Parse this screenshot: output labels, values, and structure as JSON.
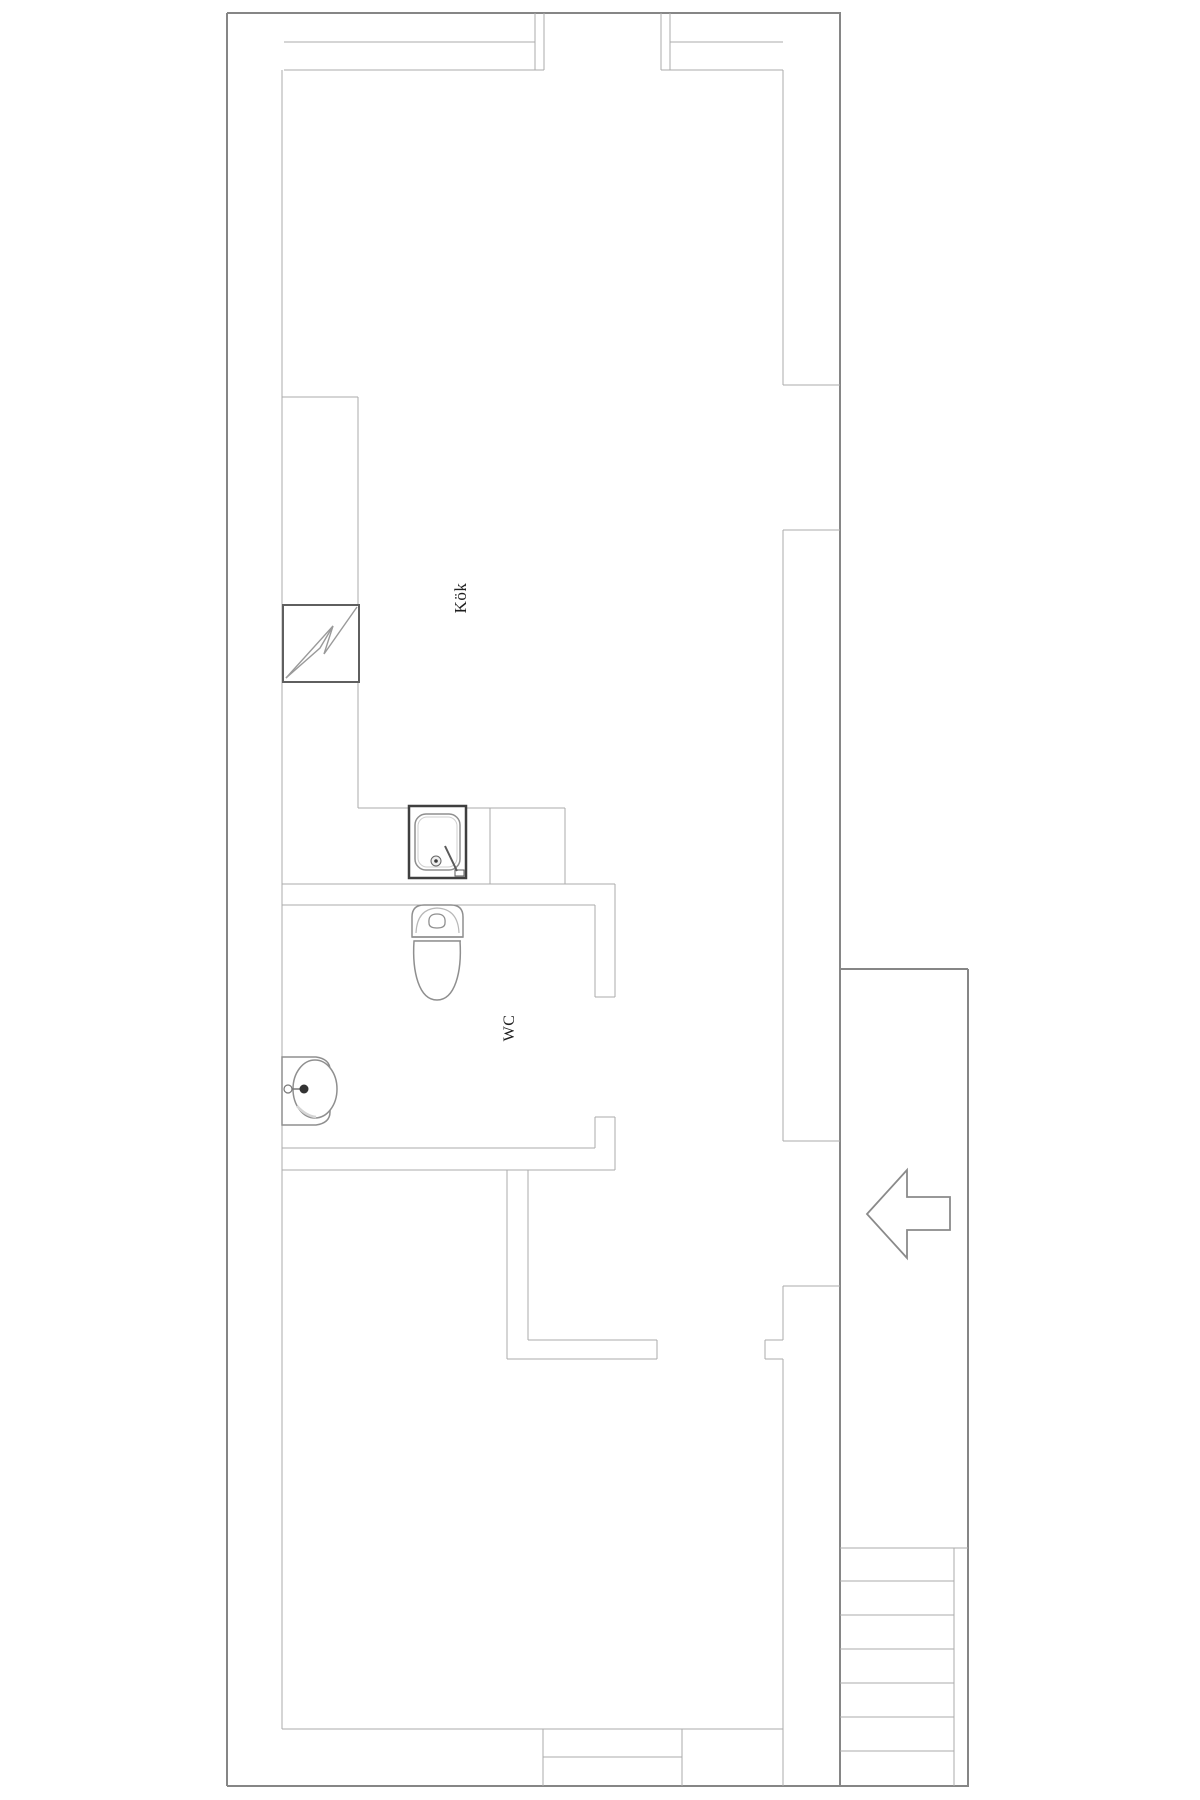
{
  "canvas": {
    "width": 1200,
    "height": 1800,
    "background": "#ffffff"
  },
  "colors": {
    "wall_outer": "#868686",
    "wall_inner": "#ababab",
    "fixture": "#8f8f8f",
    "fixture_dark": "#3f3f3f",
    "label_text": "#1f1f1f"
  },
  "rooms": [
    {
      "id": "kok",
      "label": "Kök",
      "x": 461,
      "y": 598,
      "rotation": -90,
      "font_size": 17
    },
    {
      "id": "wc",
      "label": "WC",
      "x": 510,
      "y": 1028,
      "rotation": -90,
      "font_size": 16
    }
  ],
  "walls": [
    {
      "x1": 227,
      "y1": 13,
      "x2": 841,
      "y2": 13,
      "k": "outer"
    },
    {
      "x1": 227,
      "y1": 13,
      "x2": 227,
      "y2": 1786,
      "k": "outer"
    },
    {
      "x1": 840,
      "y1": 13,
      "x2": 840,
      "y2": 1786,
      "k": "outer"
    },
    {
      "x1": 227,
      "y1": 1786,
      "x2": 969,
      "y2": 1786,
      "k": "outer"
    },
    {
      "x1": 968,
      "y1": 969,
      "x2": 968,
      "y2": 1786,
      "k": "outer"
    },
    {
      "x1": 840,
      "y1": 969,
      "x2": 968,
      "y2": 969,
      "k": "outer"
    },
    {
      "x1": 282,
      "y1": 70,
      "x2": 282,
      "y2": 1729,
      "k": "inner"
    },
    {
      "x1": 284,
      "y1": 42,
      "x2": 535,
      "y2": 42,
      "k": "inner"
    },
    {
      "x1": 284,
      "y1": 70,
      "x2": 544,
      "y2": 70,
      "k": "inner"
    },
    {
      "x1": 535,
      "y1": 13,
      "x2": 535,
      "y2": 70,
      "k": "inner"
    },
    {
      "x1": 544,
      "y1": 13,
      "x2": 544,
      "y2": 70,
      "k": "inner"
    },
    {
      "x1": 661,
      "y1": 13,
      "x2": 661,
      "y2": 70,
      "k": "inner"
    },
    {
      "x1": 670,
      "y1": 13,
      "x2": 670,
      "y2": 70,
      "k": "inner"
    },
    {
      "x1": 670,
      "y1": 42,
      "x2": 783,
      "y2": 42,
      "k": "inner"
    },
    {
      "x1": 661,
      "y1": 70,
      "x2": 783,
      "y2": 70,
      "k": "inner"
    },
    {
      "x1": 783,
      "y1": 70,
      "x2": 783,
      "y2": 385,
      "k": "inner"
    },
    {
      "x1": 783,
      "y1": 385,
      "x2": 840,
      "y2": 385,
      "k": "inner"
    },
    {
      "x1": 783,
      "y1": 530,
      "x2": 840,
      "y2": 530,
      "k": "inner"
    },
    {
      "x1": 783,
      "y1": 530,
      "x2": 783,
      "y2": 1141,
      "k": "inner"
    },
    {
      "x1": 783,
      "y1": 1141,
      "x2": 840,
      "y2": 1141,
      "k": "inner"
    },
    {
      "x1": 783,
      "y1": 1286,
      "x2": 840,
      "y2": 1286,
      "k": "inner"
    },
    {
      "x1": 783,
      "y1": 1286,
      "x2": 783,
      "y2": 1340,
      "k": "inner"
    },
    {
      "x1": 765,
      "y1": 1340,
      "x2": 783,
      "y2": 1340,
      "k": "inner"
    },
    {
      "x1": 765,
      "y1": 1340,
      "x2": 765,
      "y2": 1359,
      "k": "inner"
    },
    {
      "x1": 765,
      "y1": 1359,
      "x2": 783,
      "y2": 1359,
      "k": "inner"
    },
    {
      "x1": 783,
      "y1": 1359,
      "x2": 783,
      "y2": 1786,
      "k": "inner"
    },
    {
      "x1": 282,
      "y1": 397,
      "x2": 358,
      "y2": 397,
      "k": "inner"
    },
    {
      "x1": 358,
      "y1": 397,
      "x2": 358,
      "y2": 605,
      "k": "inner"
    },
    {
      "x1": 358,
      "y1": 682,
      "x2": 358,
      "y2": 808,
      "k": "inner"
    },
    {
      "x1": 358,
      "y1": 808,
      "x2": 565,
      "y2": 808,
      "k": "inner"
    },
    {
      "x1": 490,
      "y1": 808,
      "x2": 490,
      "y2": 884,
      "k": "inner"
    },
    {
      "x1": 565,
      "y1": 808,
      "x2": 565,
      "y2": 884,
      "k": "inner"
    },
    {
      "x1": 282,
      "y1": 884,
      "x2": 615,
      "y2": 884,
      "k": "inner"
    },
    {
      "x1": 282,
      "y1": 905,
      "x2": 595,
      "y2": 905,
      "k": "inner"
    },
    {
      "x1": 595,
      "y1": 905,
      "x2": 595,
      "y2": 997,
      "k": "inner"
    },
    {
      "x1": 615,
      "y1": 884,
      "x2": 615,
      "y2": 997,
      "k": "inner"
    },
    {
      "x1": 595,
      "y1": 997,
      "x2": 615,
      "y2": 997,
      "k": "inner"
    },
    {
      "x1": 595,
      "y1": 1117,
      "x2": 615,
      "y2": 1117,
      "k": "inner"
    },
    {
      "x1": 595,
      "y1": 1117,
      "x2": 595,
      "y2": 1148,
      "k": "inner"
    },
    {
      "x1": 615,
      "y1": 1117,
      "x2": 615,
      "y2": 1170,
      "k": "inner"
    },
    {
      "x1": 282,
      "y1": 1148,
      "x2": 595,
      "y2": 1148,
      "k": "inner"
    },
    {
      "x1": 282,
      "y1": 1170,
      "x2": 615,
      "y2": 1170,
      "k": "inner"
    },
    {
      "x1": 507,
      "y1": 1170,
      "x2": 507,
      "y2": 1359,
      "k": "inner"
    },
    {
      "x1": 528,
      "y1": 1170,
      "x2": 528,
      "y2": 1340,
      "k": "inner"
    },
    {
      "x1": 528,
      "y1": 1340,
      "x2": 657,
      "y2": 1340,
      "k": "inner"
    },
    {
      "x1": 507,
      "y1": 1359,
      "x2": 657,
      "y2": 1359,
      "k": "inner"
    },
    {
      "x1": 657,
      "y1": 1340,
      "x2": 657,
      "y2": 1359,
      "k": "inner"
    },
    {
      "x1": 282,
      "y1": 1729,
      "x2": 783,
      "y2": 1729,
      "k": "inner"
    },
    {
      "x1": 543,
      "y1": 1729,
      "x2": 543,
      "y2": 1786,
      "k": "inner"
    },
    {
      "x1": 682,
      "y1": 1729,
      "x2": 682,
      "y2": 1786,
      "k": "inner"
    },
    {
      "x1": 543,
      "y1": 1757,
      "x2": 682,
      "y2": 1757,
      "k": "inner"
    },
    {
      "x1": 954,
      "y1": 1548,
      "x2": 954,
      "y2": 1786,
      "k": "inner"
    }
  ],
  "stairs": {
    "x1": 840,
    "x2": 954,
    "first_x2": 968,
    "ys": [
      1548,
      1581,
      1615,
      1649,
      1683,
      1717,
      1751
    ]
  },
  "fixtures": [
    {
      "name": "stove-icon",
      "shapes": [
        {
          "type": "rect",
          "x": 283,
          "y": 605,
          "width": 76,
          "height": 77,
          "fill": "none",
          "stroke": "#5f5f5f",
          "stroke-width": 2
        },
        {
          "type": "polyline",
          "points": "286,678 333,626 324,654 357,607",
          "fill": "none",
          "stroke": "#9a9a9a",
          "stroke-width": 1.4
        },
        {
          "type": "polyline",
          "points": "286,678 320,648 333,626",
          "fill": "none",
          "stroke": "#9a9a9a",
          "stroke-width": 1.4
        }
      ]
    },
    {
      "name": "kitchen-sink-icon",
      "shapes": [
        {
          "type": "rect",
          "x": 409,
          "y": 806,
          "width": 57,
          "height": 72,
          "fill": "#ffffff",
          "stroke": "#3f3f3f",
          "stroke-width": 2.5
        },
        {
          "type": "rect",
          "x": 415,
          "y": 814,
          "width": 45,
          "height": 56,
          "rx": 11,
          "fill": "none",
          "stroke": "#8f8f8f",
          "stroke-width": 1.5
        },
        {
          "type": "rect",
          "x": 418,
          "y": 817,
          "width": 39,
          "height": 50,
          "rx": 9,
          "fill": "none",
          "stroke": "#cfcfcf",
          "stroke-width": 1
        },
        {
          "type": "circle",
          "cx": 436,
          "cy": 861,
          "r": 5,
          "fill": "#eeeeee",
          "stroke": "#666666",
          "stroke-width": 1
        },
        {
          "type": "circle",
          "cx": 436,
          "cy": 861,
          "r": 1.8,
          "fill": "#3a3a3a"
        },
        {
          "type": "line",
          "x1": 445,
          "y1": 846,
          "x2": 457,
          "y2": 871,
          "stroke": "#5a5a5a",
          "stroke-width": 2
        },
        {
          "type": "rect",
          "x": 455,
          "y": 870,
          "width": 9,
          "height": 6,
          "fill": "none",
          "stroke": "#5a5a5a",
          "stroke-width": 1
        }
      ]
    },
    {
      "name": "toilet-icon",
      "shapes": [
        {
          "type": "path",
          "d": "M412,937 L412,917 Q412,905 424,905 L451,905 Q463,905 463,917 L463,937 Z",
          "fill": "#ffffff",
          "stroke": "#8f8f8f",
          "stroke-width": 1.5
        },
        {
          "type": "path",
          "d": "M416,933 Q417,909 437,908 Q458,909 459,933",
          "fill": "none",
          "stroke": "#b8b8b8",
          "stroke-width": 1.2
        },
        {
          "type": "path",
          "d": "M429,923 Q428,914 437,914 Q446,914 445,923 Q445,928 437,928 Q429,928 429,923 Z",
          "fill": "#ffffff",
          "stroke": "#8f8f8f",
          "stroke-width": 1.3
        },
        {
          "type": "line",
          "x1": 412,
          "y1": 937,
          "x2": 463,
          "y2": 937,
          "stroke": "#8f8f8f",
          "stroke-width": 1.5
        },
        {
          "type": "line",
          "x1": 414,
          "y1": 941,
          "x2": 461,
          "y2": 941,
          "stroke": "#8f8f8f",
          "stroke-width": 1.2
        },
        {
          "type": "path",
          "d": "M414,941 C412,972 419,1000 437,1000 C455,1000 462,972 460,941 Z",
          "fill": "#ffffff",
          "stroke": "#8f8f8f",
          "stroke-width": 1.5
        }
      ]
    },
    {
      "name": "washbasin-icon",
      "shapes": [
        {
          "type": "path",
          "d": "M282,1057 L316,1057 Q330,1059 330,1070 L330,1112 Q330,1123 316,1125 L282,1125 Z",
          "fill": "#ffffff",
          "stroke": "#8f8f8f",
          "stroke-width": 1.5
        },
        {
          "type": "ellipse",
          "cx": 315,
          "cy": 1089,
          "rx": 22,
          "ry": 29,
          "fill": "#ffffff",
          "stroke": "#8f8f8f",
          "stroke-width": 1.5
        },
        {
          "type": "path",
          "d": "M297,1106 Q306,1116 316,1117",
          "fill": "none",
          "stroke": "#d5d5d5",
          "stroke-width": 2.5
        },
        {
          "type": "circle",
          "cx": 288,
          "cy": 1089,
          "r": 4,
          "fill": "#ffffff",
          "stroke": "#777777",
          "stroke-width": 1.2
        },
        {
          "type": "line",
          "x1": 292,
          "y1": 1089,
          "x2": 301,
          "y2": 1089,
          "stroke": "#777777",
          "stroke-width": 1.5
        },
        {
          "type": "circle",
          "cx": 304,
          "cy": 1089,
          "r": 4.5,
          "fill": "#333333"
        }
      ]
    },
    {
      "name": "entrance-arrow-icon",
      "shapes": [
        {
          "type": "polygon",
          "points": "867,1214 907,1170 907,1197 950,1197 950,1230 907,1230 907,1258",
          "fill": "#ffffff",
          "stroke": "#8a8a8a",
          "stroke-width": 1.8
        }
      ]
    }
  ]
}
